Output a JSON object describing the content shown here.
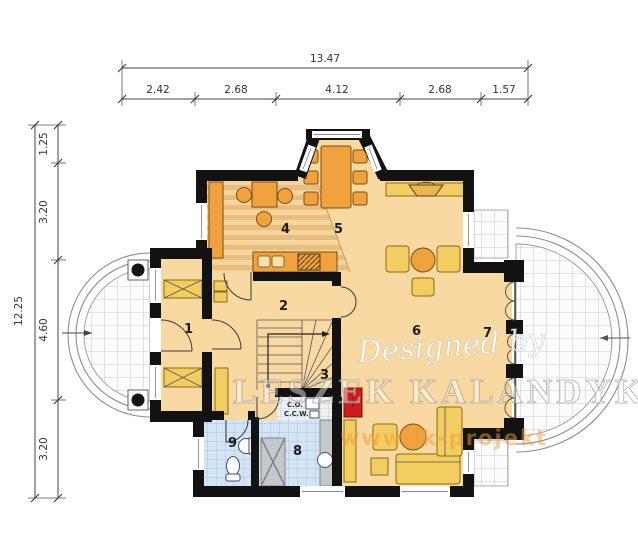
{
  "dimensions": {
    "top": {
      "total": "13.47",
      "segments": [
        "2.42",
        "2.68",
        "4.12",
        "2.68",
        "1.57"
      ]
    },
    "left": {
      "total": "12.25",
      "segments": [
        "1.25",
        "3.20",
        "4.60",
        "3.20"
      ]
    }
  },
  "room_numbers": [
    "1",
    "2",
    "3",
    "4",
    "5",
    "6",
    "7",
    "8",
    "9"
  ],
  "boiler_labels": [
    "C.O.",
    "C.C.W."
  ],
  "watermark": {
    "designed_by": "Designed by",
    "name": "LESZEK KALANDYK",
    "url": "www.lk-projekt"
  },
  "colors": {
    "wall": "#121212",
    "floor": "#f7d9a1",
    "furniture_orange": "#efa23d",
    "furniture_yellow": "#f2cd62",
    "tile_blue": "#d3e4f4",
    "shower_gray": "#c3c8cd",
    "chimney_red": "#cf1d1d",
    "wood_light": "#f3d59d",
    "wood_dark": "#e9bd7d",
    "terrace_line": "#8d8d8d"
  }
}
